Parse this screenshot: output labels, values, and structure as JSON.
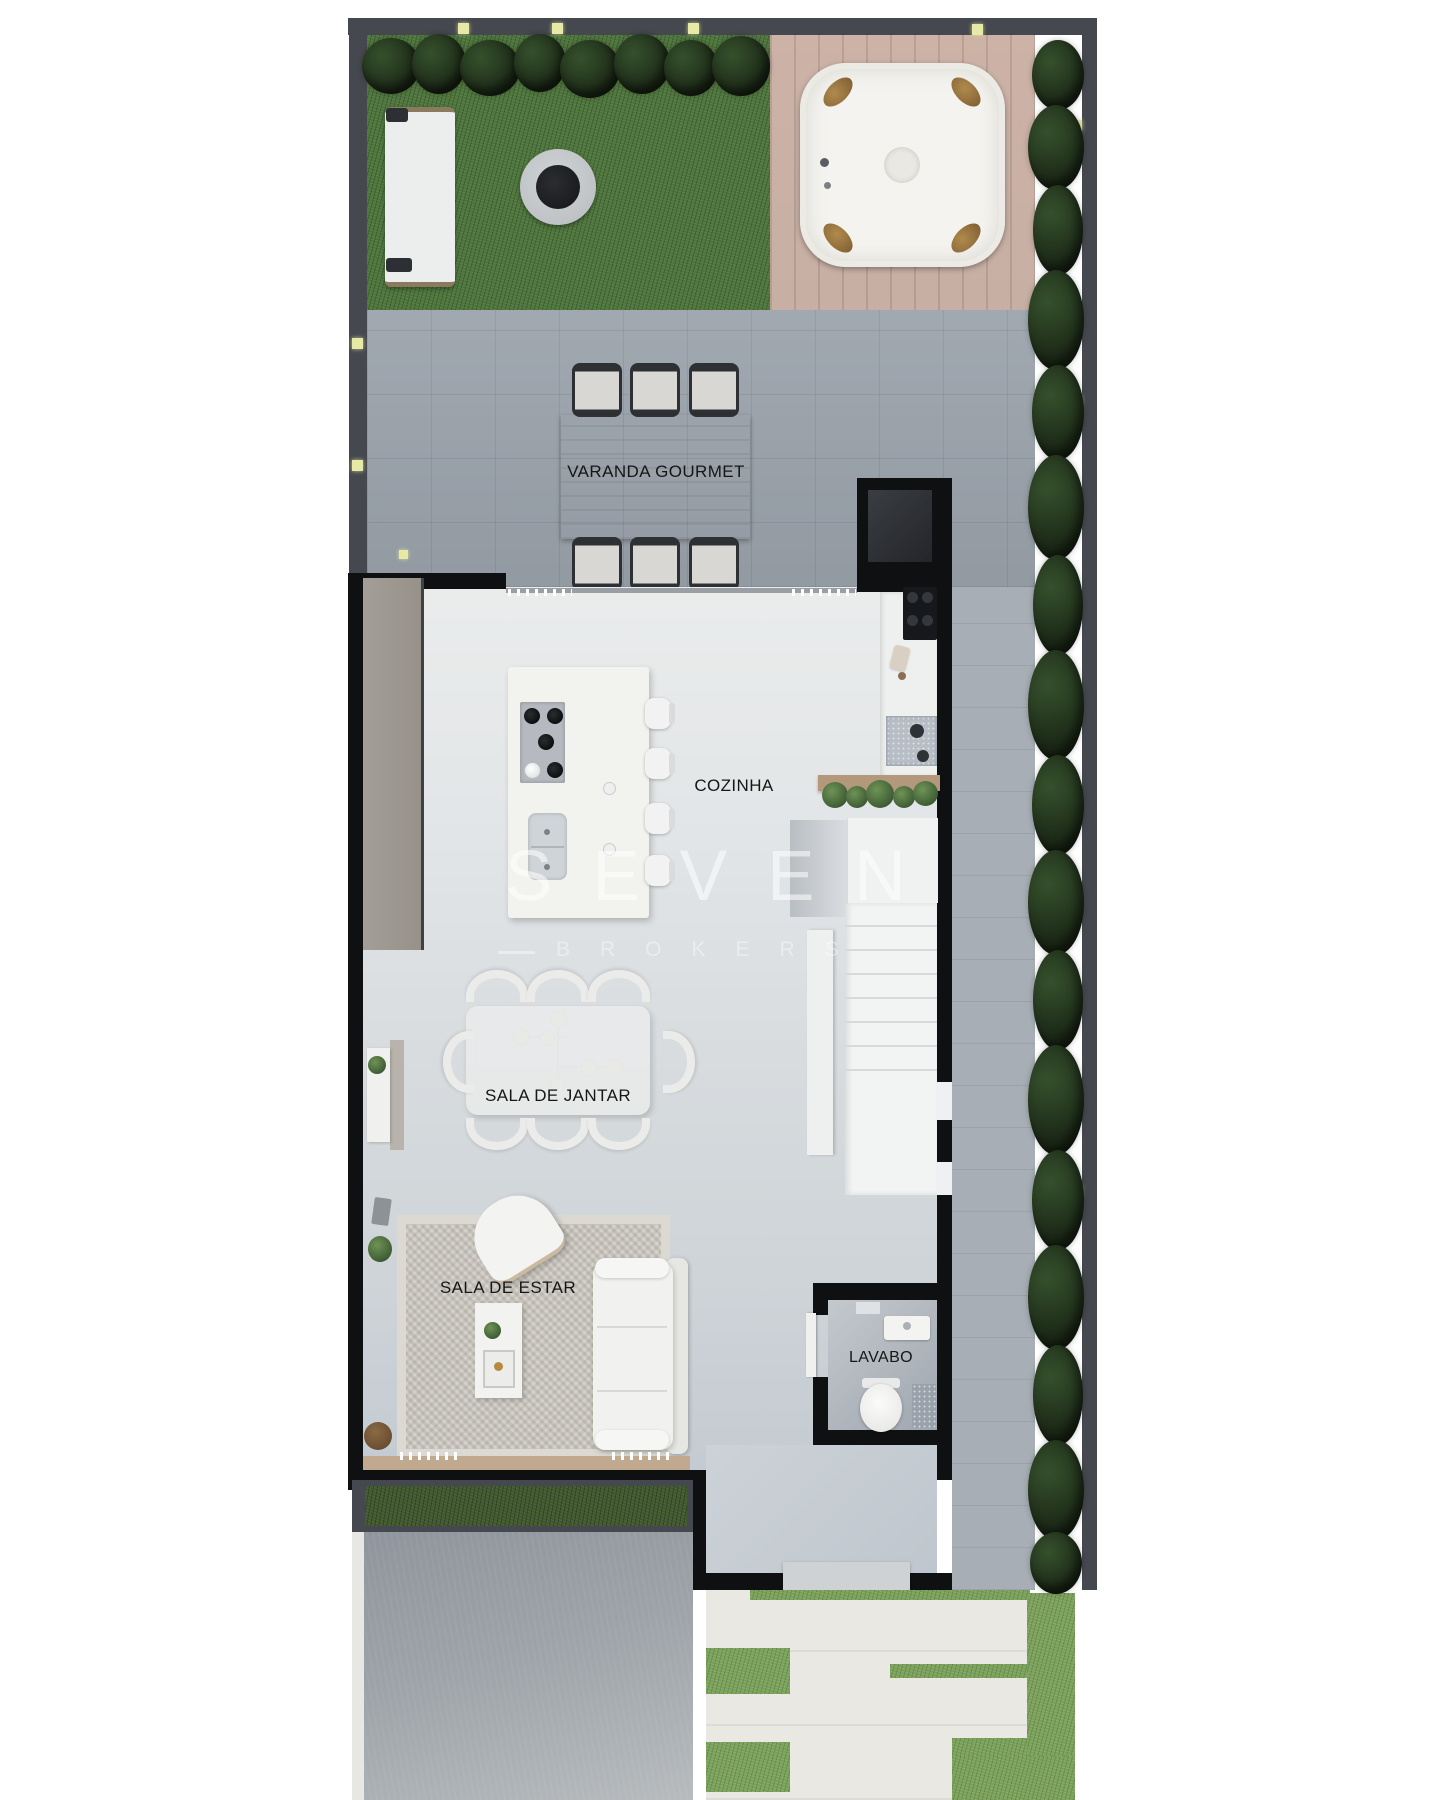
{
  "watermark": {
    "brand": "SEVEN",
    "subtitle": "BROKERS",
    "dash": "—"
  },
  "rooms": [
    {
      "id": "varanda-gourmet",
      "label": "VARANDA GOURMET"
    },
    {
      "id": "cozinha",
      "label": "COZINHA"
    },
    {
      "id": "sala-de-jantar",
      "label": "SALA DE JANTAR"
    },
    {
      "id": "sala-de-estar",
      "label": "SALA DE ESTAR"
    },
    {
      "id": "lavabo",
      "label": "LAVABO"
    }
  ],
  "colors": {
    "wall-dark": "#45484f",
    "wall-black": "#0f1012",
    "grass": "#4e763c",
    "grass-dark": "#41592f",
    "grass-light": "#7aa159",
    "hedge": "#1c2917",
    "deck": "#c7afa4",
    "tile": "#9ba3ac",
    "path": "#a7aeb5",
    "floor-top": "#eaecec",
    "floor-bottom": "#c3cad1",
    "furniture-white": "#f2f2ef",
    "wood-table": "#c4b499",
    "wood-shelf": "#b3987c",
    "wood-sill": "#c0a98e",
    "rug": "#d5d2cb",
    "concrete": "#8f959c",
    "concrete-light": "#b7bbbe",
    "paver": "#e9e8e2",
    "vestibule": "#bfc6cd",
    "cooktop-gray": "#b6bac0",
    "light-square": "#e7e9a6",
    "label": "#161616"
  }
}
